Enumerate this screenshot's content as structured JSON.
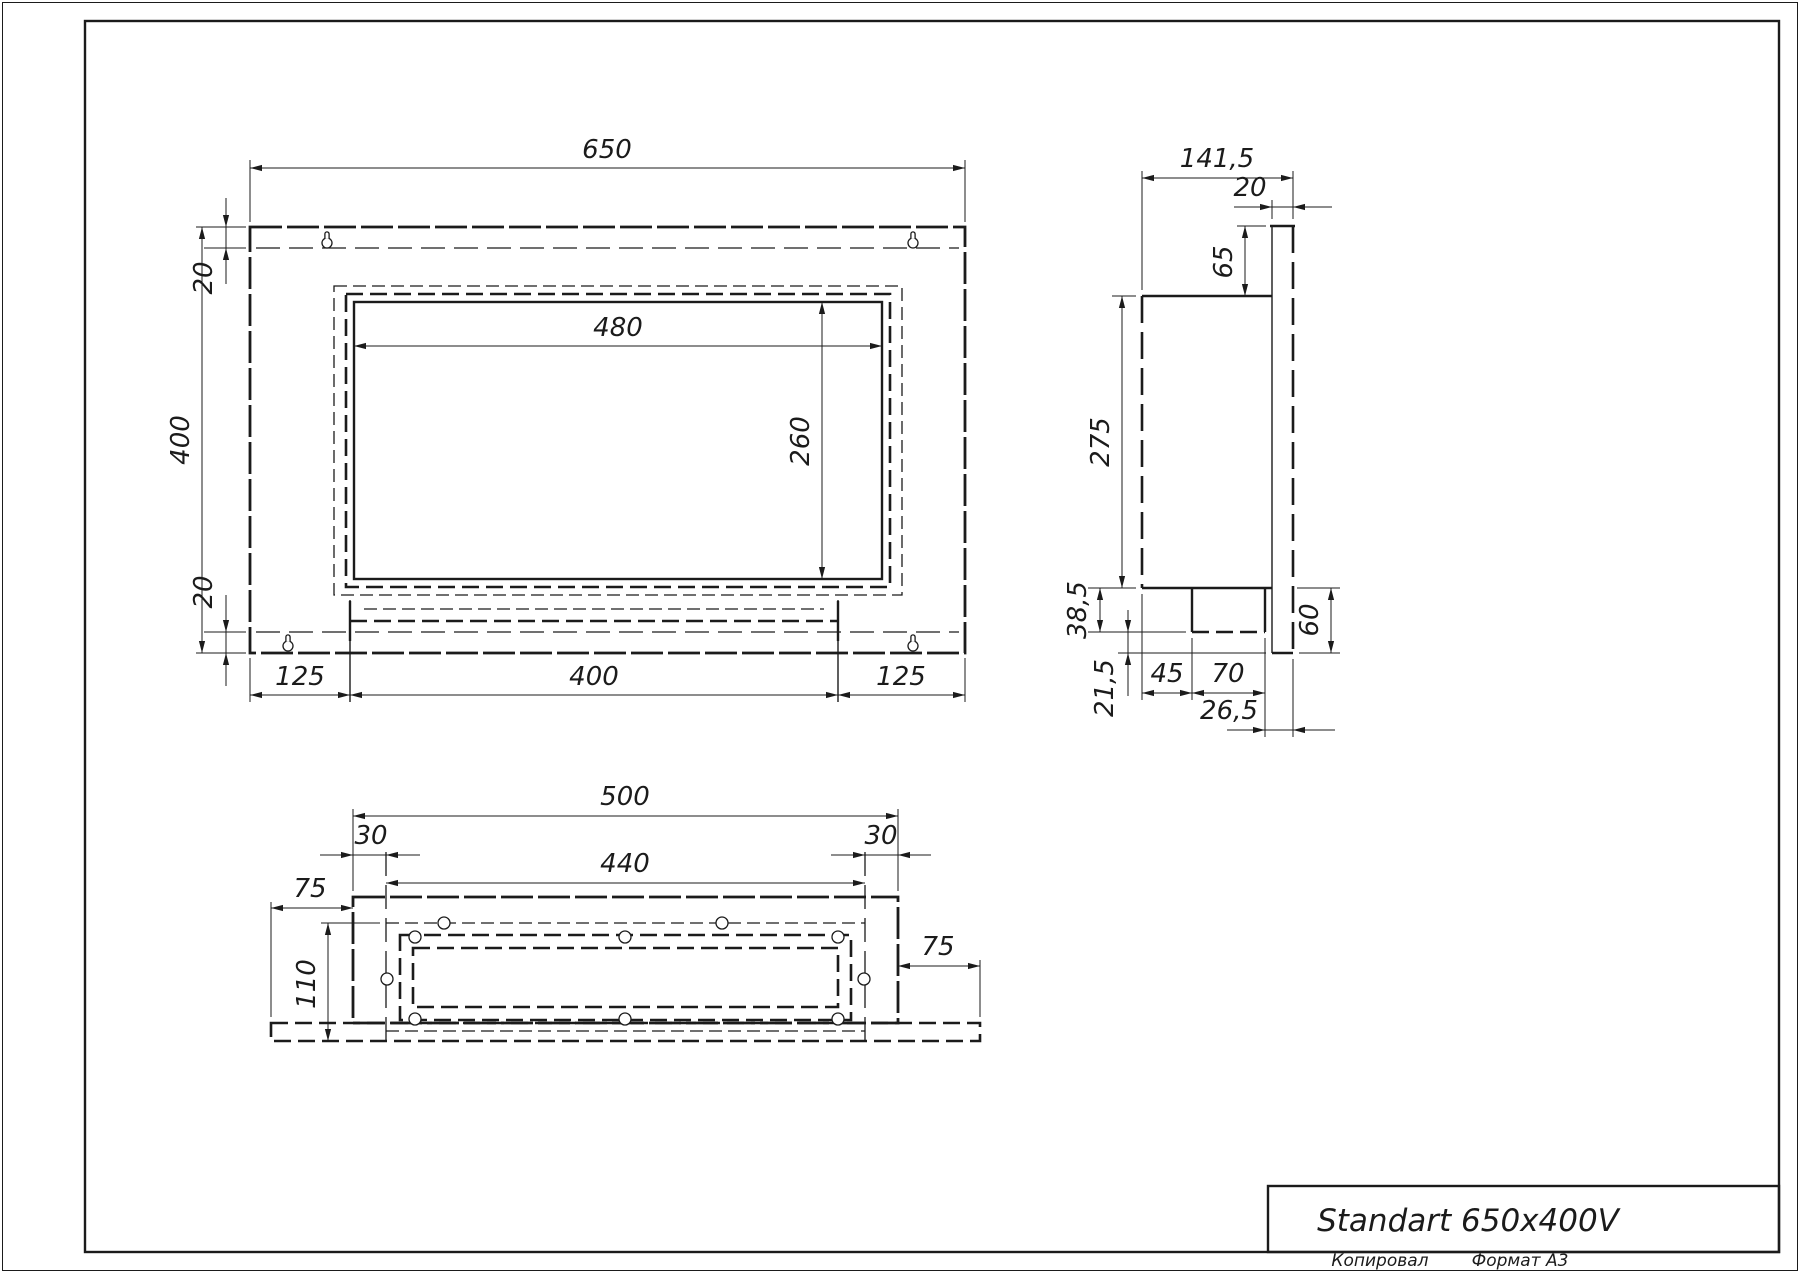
{
  "title_block": {
    "title": "Standart 650x400V"
  },
  "footer": {
    "copied": "Копировал",
    "format": "Формат А3"
  },
  "front": {
    "w": "650",
    "h": "400",
    "inset_top": "20",
    "inset_bottom": "20",
    "opening_w": "480",
    "opening_h": "260",
    "bottom_left": "125",
    "bottom_center": "400",
    "bottom_right": "125"
  },
  "side": {
    "depth": "141,5",
    "flange_t": "20",
    "top_offset": "65",
    "body_h": "275",
    "drop1": "38,5",
    "drop2": "21,5",
    "seg1": "45",
    "seg2": "70",
    "seg3": "26,5",
    "right_ext": "60"
  },
  "bottom": {
    "w": "500",
    "inset_l": "30",
    "inner_w": "440",
    "inset_r": "30",
    "wing_l": "75",
    "d": "110",
    "wing_r": "75"
  }
}
